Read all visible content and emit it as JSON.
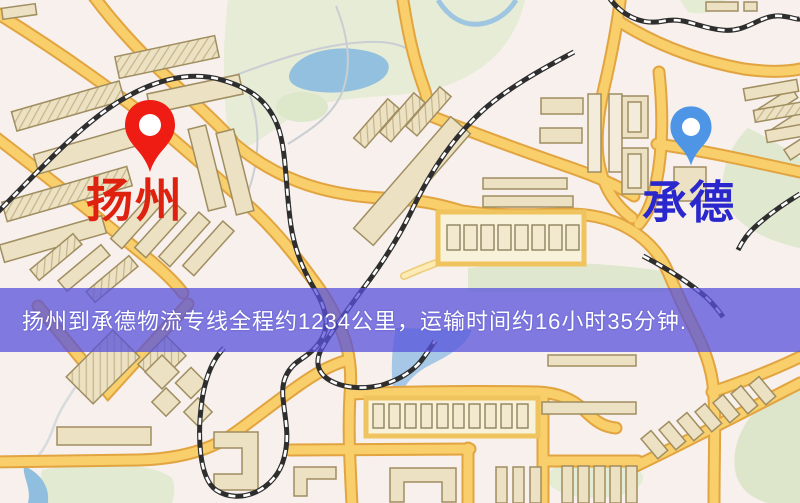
{
  "banner": {
    "text": "扬州到承德物流专线全程约1234公里，运输时间约16小时35分钟.",
    "text_color": "#ffffff",
    "background_color": "rgba(86,81,220,0.74)"
  },
  "route": {
    "origin": "扬州",
    "destination": "承德",
    "distance_text": "约1234公里",
    "duration_text": "约16小时35分钟"
  },
  "map": {
    "origin_pin": {
      "label": "扬州",
      "color": "#ee1c13",
      "label_color": "#df2110"
    },
    "destination_pin": {
      "label": "承德",
      "color": "#4e95e6",
      "label_color": "#2a28cd"
    },
    "palette": {
      "background": "#f7f0ec",
      "road_fill": "#f8cf6a",
      "road_casing": "#e2a440",
      "minor_road": "#fcebb4",
      "water": "#93c0df",
      "park": "#e3ead2",
      "building": "#ece1c2",
      "building_outline": "#a08e61",
      "railway": "#2e2e2e"
    }
  }
}
